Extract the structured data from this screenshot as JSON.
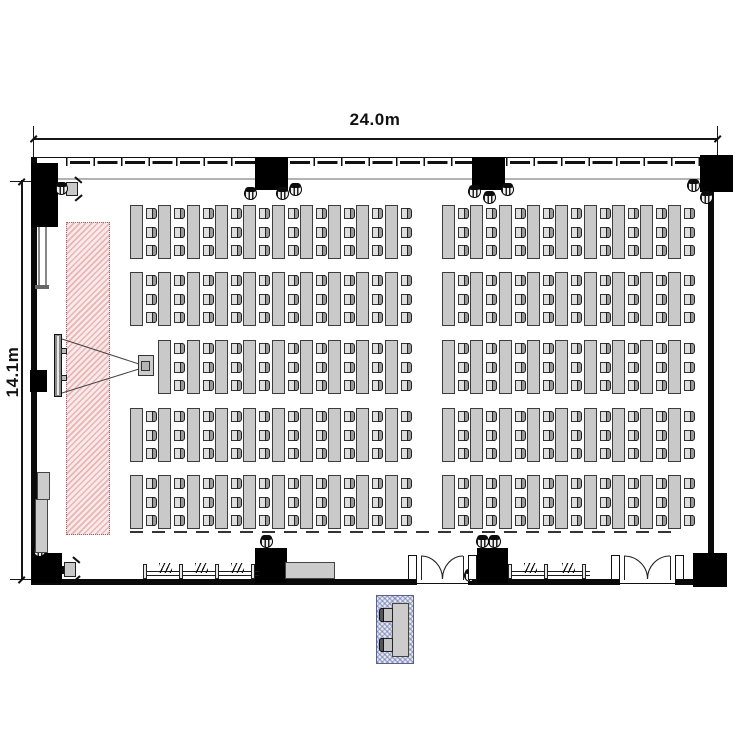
{
  "dimension_labels": {
    "width": "24.0m",
    "height": "14.1m"
  },
  "colors": {
    "wall": "#0a0a0a",
    "table_fill": "#c9c9c9",
    "screen_zone_stripe": "#d67878",
    "booth_hatch": "#606ca2",
    "curtain_line": "#b3b3b3"
  },
  "seating": {
    "rows": 5,
    "row_y": [
      205,
      272,
      340,
      408,
      475
    ],
    "left_start_x": 130,
    "right_start_x": 442,
    "left_columns": 10,
    "right_columns": 9,
    "col_spacing": 28.3,
    "chairs_per_table": 3,
    "table_w": 13,
    "table_h": 54,
    "cluster_w": 25,
    "chair_offsets": [
      3,
      21.5,
      40
    ],
    "projector_replaces": {
      "row": 2,
      "side": "left",
      "col": 0
    },
    "total_tables": 94,
    "total_seats": 282
  },
  "columns": [
    [
      31,
      163,
      27,
      64
    ],
    [
      255,
      157,
      33,
      33
    ],
    [
      472,
      157,
      33,
      33
    ],
    [
      700,
      155,
      33,
      37
    ],
    [
      30,
      370,
      17,
      22
    ],
    [
      32,
      553,
      30,
      30
    ],
    [
      255,
      548,
      32,
      35
    ],
    [
      477,
      548,
      31,
      35
    ],
    [
      693,
      553,
      34,
      34
    ]
  ],
  "speakers": [
    [
      55,
      182
    ],
    [
      244,
      187
    ],
    [
      276,
      187
    ],
    [
      289,
      183
    ],
    [
      468,
      185
    ],
    [
      483,
      191
    ],
    [
      501,
      183
    ],
    [
      687,
      179
    ],
    [
      700,
      191
    ],
    [
      33,
      544
    ],
    [
      260,
      535
    ],
    [
      476,
      535
    ],
    [
      488,
      535
    ],
    [
      464,
      569
    ]
  ],
  "railings": [
    {
      "x": 143,
      "y": 562,
      "w": 112,
      "posts": [
        0,
        36,
        72,
        108
      ],
      "hatches": [
        16,
        52,
        88
      ]
    },
    {
      "x": 508,
      "y": 562,
      "w": 78,
      "posts": [
        0,
        36,
        74
      ],
      "hatches": [
        16,
        54
      ]
    }
  ],
  "doors": [
    {
      "x": 417,
      "w": 51
    },
    {
      "x": 620,
      "w": 55
    }
  ],
  "cabinets": [
    [
      37,
      472,
      13,
      28
    ],
    [
      35,
      499,
      13,
      54
    ],
    [
      285,
      562,
      50,
      17
    ]
  ],
  "legend": {
    "screen_zone": "screen-projection-area",
    "screen": "projection-screen",
    "projector": "projector",
    "speaker": "ceiling-speaker",
    "door": "double-swing-door",
    "booth": "operator-booth"
  }
}
